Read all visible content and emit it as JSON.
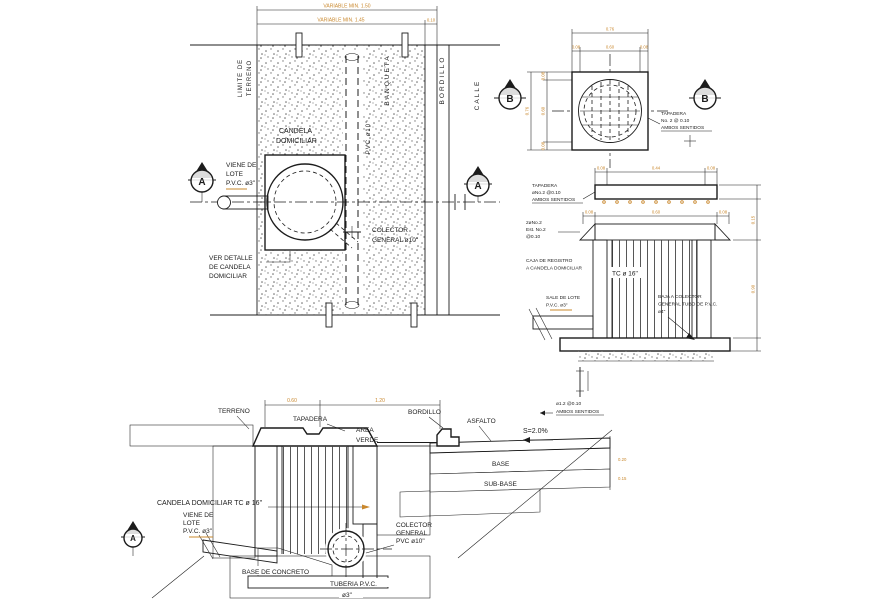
{
  "drawing_title": "Detalle de candela domiciliar - planta y secciones",
  "colors": {
    "ink": "#1c1c1c",
    "dim_text": "#c9882e",
    "paper": "#ffffff"
  },
  "plan": {
    "dim1": "VARIABLE MIN. 1.50",
    "dim2": "VARIABLE MIN. 1.45",
    "dim3": "0.10",
    "limite": [
      "LIMITE DE",
      "TERRENO"
    ],
    "banqueta": "BANQUETA",
    "bordillo": "BORDILLO",
    "calle": "CALLE",
    "pvc10": "PVC ø10\"",
    "candela": [
      "CANDELA",
      "DOMICILIAR"
    ],
    "viene": [
      "VIENE DE",
      "LOTE",
      "P.V.C. ø3\""
    ],
    "colector": [
      "COLECTOR",
      "GENERAL ø10\""
    ],
    "ver_detalle": [
      "VER DETALLE",
      "DE CANDELA",
      "DOMICILIAR"
    ],
    "marker": "A"
  },
  "lid_plan": {
    "marker": "B",
    "dim_total_top": "0.76",
    "dims_top": [
      "0.08",
      "0.60",
      "0.08"
    ],
    "dim_total_left": "0.76",
    "dims_left": [
      "0.08",
      "0.60",
      "0.08"
    ],
    "note": [
      "TAPADERA",
      "No. 2 @ 0.10",
      "AMBOS SENTIDOS"
    ]
  },
  "section_b": {
    "dims_top": [
      "0.08",
      "0.44",
      "0.08"
    ],
    "dims_mid": [
      "0.08",
      "0.60",
      "0.08"
    ],
    "dim_right_top": "0.15",
    "dim_right": "0.90",
    "tapadera_note": [
      "TAPADERA",
      "øNo.2  @0.10",
      "AMBOS SENTIDOS"
    ],
    "rebar_note": [
      "2øNo.2",
      "Est. No.2",
      "@0.10"
    ],
    "caja_note": [
      "CAJA DE REGISTRO",
      "A CANDELA DOMICILIAR"
    ],
    "tc": "TC ø 16\"",
    "sale": [
      "SALE DE LOTE",
      "P.V.C. ø3\""
    ],
    "baja": [
      "BAJA A COLECTOR",
      "GENERAL TUBO DE P.V.C.",
      "ø4\""
    ],
    "detail_note": [
      "ø1.2   @0.10",
      "AMBOS SENTIDOS"
    ]
  },
  "section_a": {
    "dims_top": [
      "0.60",
      "1.20"
    ],
    "terreno": "TERRENO",
    "tapadera": "TAPADERA",
    "area_verde": [
      "AREA",
      "VERDE"
    ],
    "bordillo": "BORDILLO",
    "asfalto": "ASFALTO",
    "slope": "S=2.0%",
    "base": "BASE",
    "subbase": "SUB-BASE",
    "dim_base": "0.20",
    "dim_subbase": "0.15",
    "candela": "CANDELA DOMICILIAR TC ø 16\"",
    "viene": [
      "VIENE DE",
      "LOTE",
      "P.V.C. ø3\""
    ],
    "colector": [
      "COLECTOR",
      "GENERAL",
      "PVC ø10\""
    ],
    "base_concreto": "BASE DE CONCRETO",
    "tuberia": [
      "TUBERIA  P.V.C.",
      "ø3\""
    ],
    "marker": "A"
  }
}
